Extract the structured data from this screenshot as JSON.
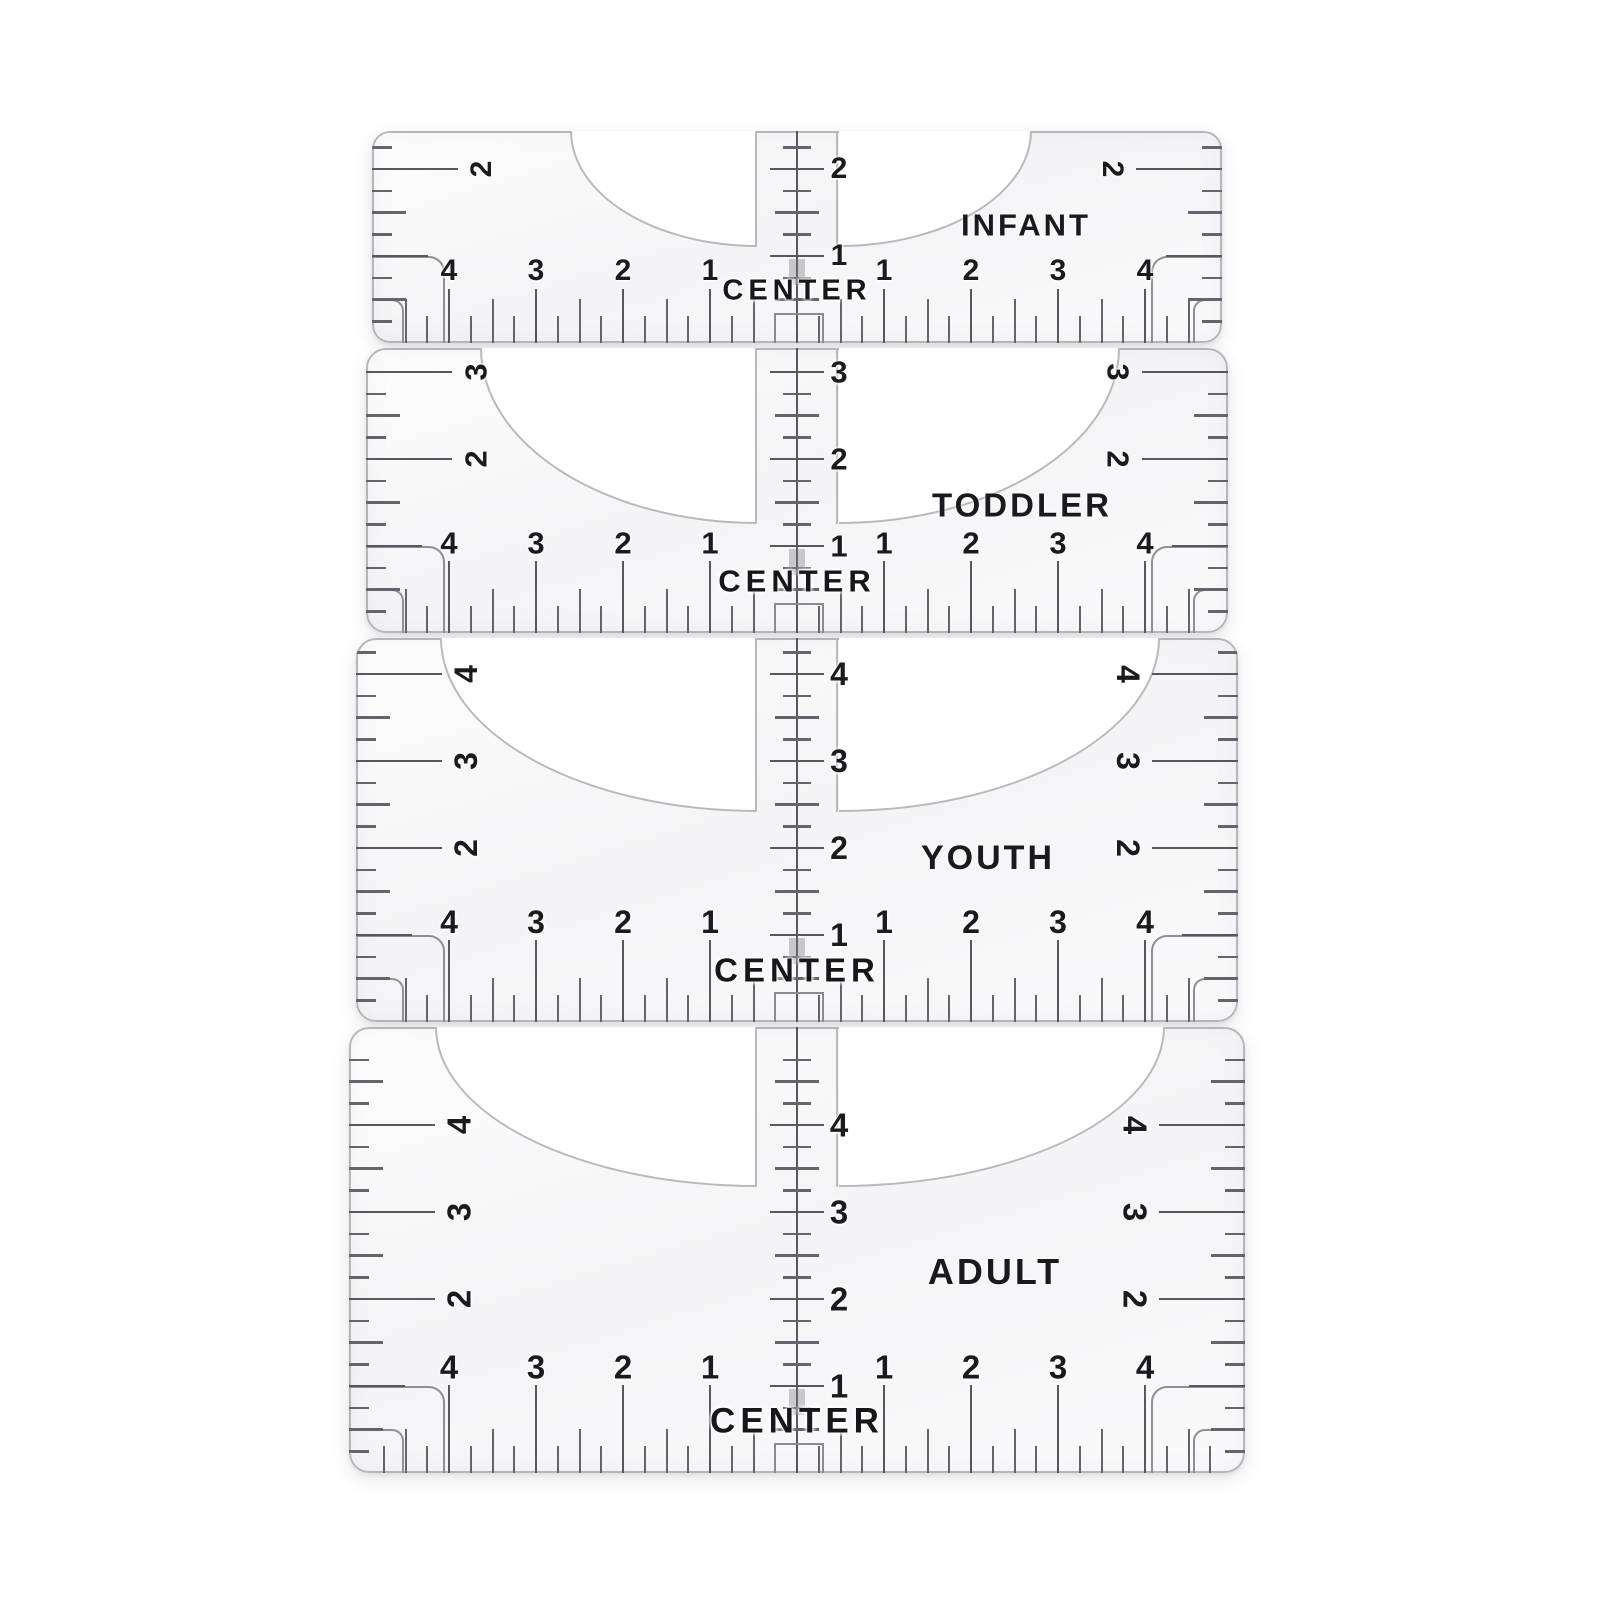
{
  "product": {
    "description": "T-shirt alignment ruler set, 4 transparent guides stacked vertically",
    "center_marker_label": "CENTER"
  },
  "rulers": [
    {
      "id": "infant",
      "size_label": "INFANT",
      "strip_inch_numbers": [
        1,
        2
      ],
      "edge_inch_numbers": [
        2
      ],
      "bottom_scale_left": [
        4,
        3,
        2,
        1
      ],
      "bottom_scale_right": [
        1,
        2,
        3,
        4
      ]
    },
    {
      "id": "toddler",
      "size_label": "TODDLER",
      "strip_inch_numbers": [
        1,
        2,
        3
      ],
      "edge_inch_numbers": [
        2,
        3
      ],
      "bottom_scale_left": [
        4,
        3,
        2,
        1
      ],
      "bottom_scale_right": [
        1,
        2,
        3,
        4
      ]
    },
    {
      "id": "youth",
      "size_label": "YOUTH",
      "strip_inch_numbers": [
        1,
        2,
        3,
        4
      ],
      "edge_inch_numbers": [
        2,
        3,
        4
      ],
      "bottom_scale_left": [
        4,
        3,
        2,
        1
      ],
      "bottom_scale_right": [
        1,
        2,
        3,
        4
      ]
    },
    {
      "id": "adult",
      "size_label": "ADULT",
      "strip_inch_numbers": [
        1,
        2,
        3,
        4
      ],
      "edge_inch_numbers": [
        2,
        3,
        4
      ],
      "bottom_scale_left": [
        4,
        3,
        2,
        1
      ],
      "bottom_scale_right": [
        1,
        2,
        3,
        4
      ]
    }
  ],
  "colors": {
    "background": "#ffffff",
    "plastic_fill": "#f6f6f8",
    "outline": "#b6b6ba",
    "tick": "#64646b",
    "number": "#1b1b1f",
    "bracket": "#8f8f96"
  }
}
